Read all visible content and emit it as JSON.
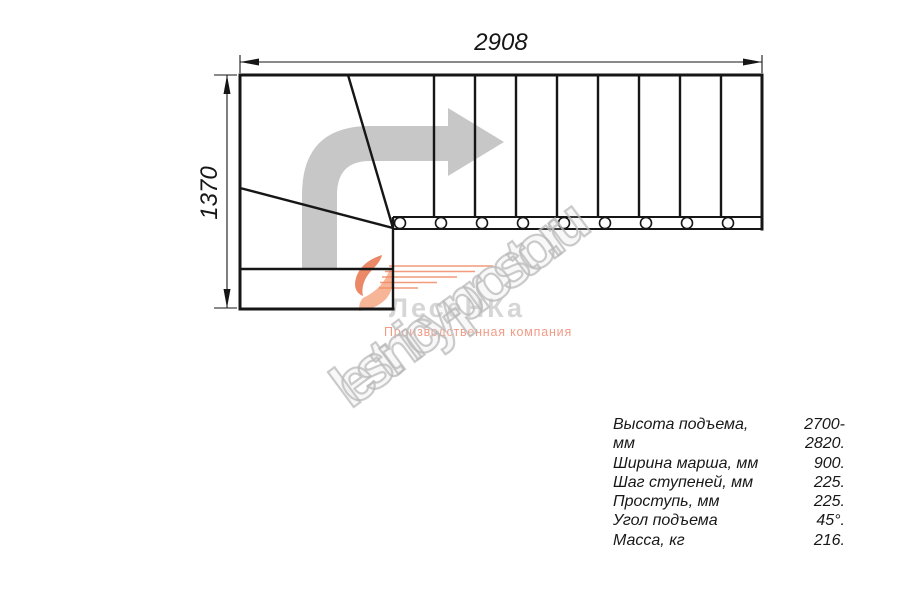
{
  "drawing": {
    "width_dim": "2908",
    "height_dim": "1370"
  },
  "specs": {
    "rows": [
      {
        "label": "Высота подъема, мм",
        "value": "2700-2820."
      },
      {
        "label": "Ширина марша, мм",
        "value": "900."
      },
      {
        "label": "Шаг ступеней, мм",
        "value": "225."
      },
      {
        "label": "Проступь, мм",
        "value": "225."
      },
      {
        "label": "Угол подъема",
        "value": "45°."
      },
      {
        "label": "Масса, кг",
        "value": "216."
      }
    ]
  },
  "logo": {
    "brand": "ЛесеНКа",
    "tagline": "Производственная компания"
  },
  "watermark": {
    "text": "lestnicy-prosto.ru"
  },
  "colors": {
    "line": "#161616",
    "arrow_gray": "#c7c7c7",
    "logo_gray": "#d6d6d6",
    "logo_salmon": "#f29b86",
    "flame_coral": "#e8734d",
    "flame_peach": "#f5ad8c",
    "watermark_gray": "#c9c9c9"
  }
}
